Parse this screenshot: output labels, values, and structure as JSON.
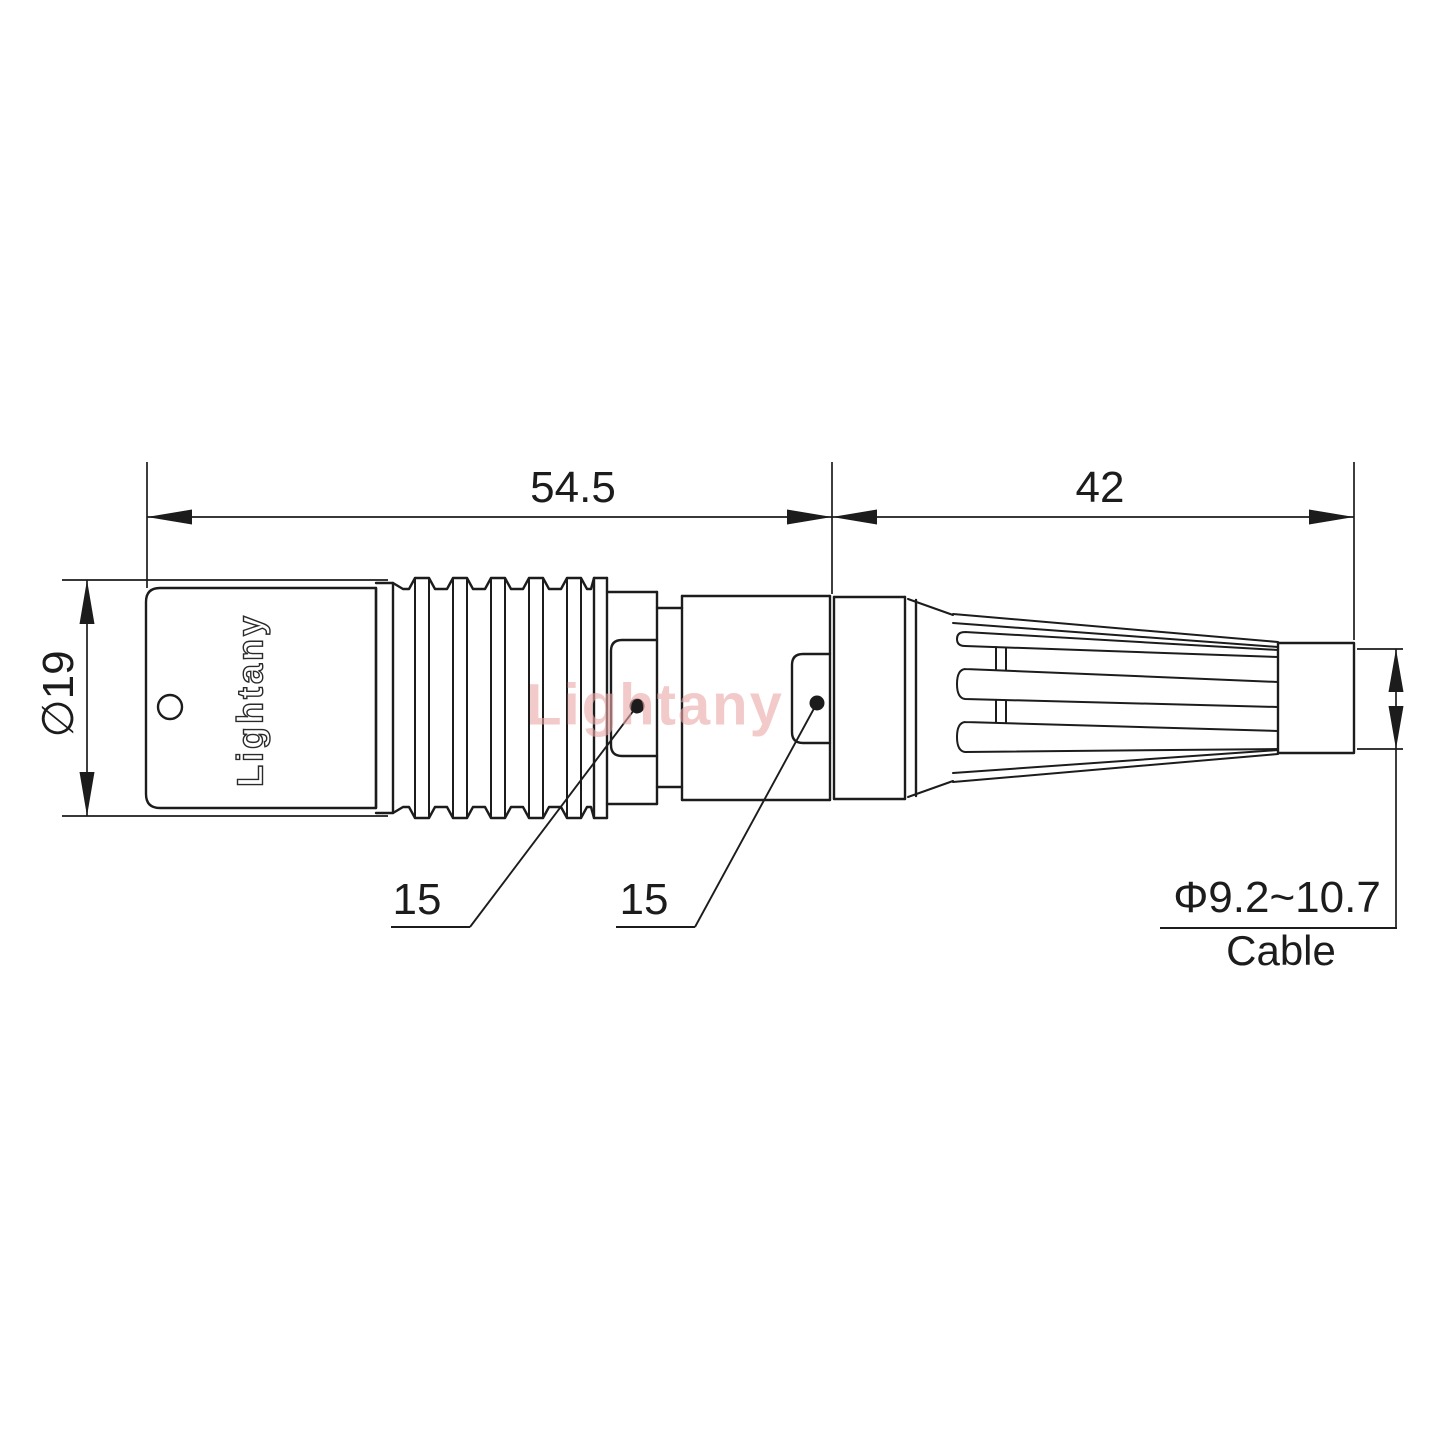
{
  "drawing": {
    "brand_label": "Lightany",
    "watermark": "Lightany",
    "dimensions": {
      "front_length": "54.5",
      "boot_length": "42",
      "body_diameter": "∅19",
      "leader_left": "15",
      "leader_right": "15",
      "cable_range": "Φ9.2~10.7",
      "cable_label": "Cable"
    },
    "colors": {
      "line": "#1c1c1c",
      "watermark": "#eba8a8",
      "background": "#ffffff"
    }
  }
}
